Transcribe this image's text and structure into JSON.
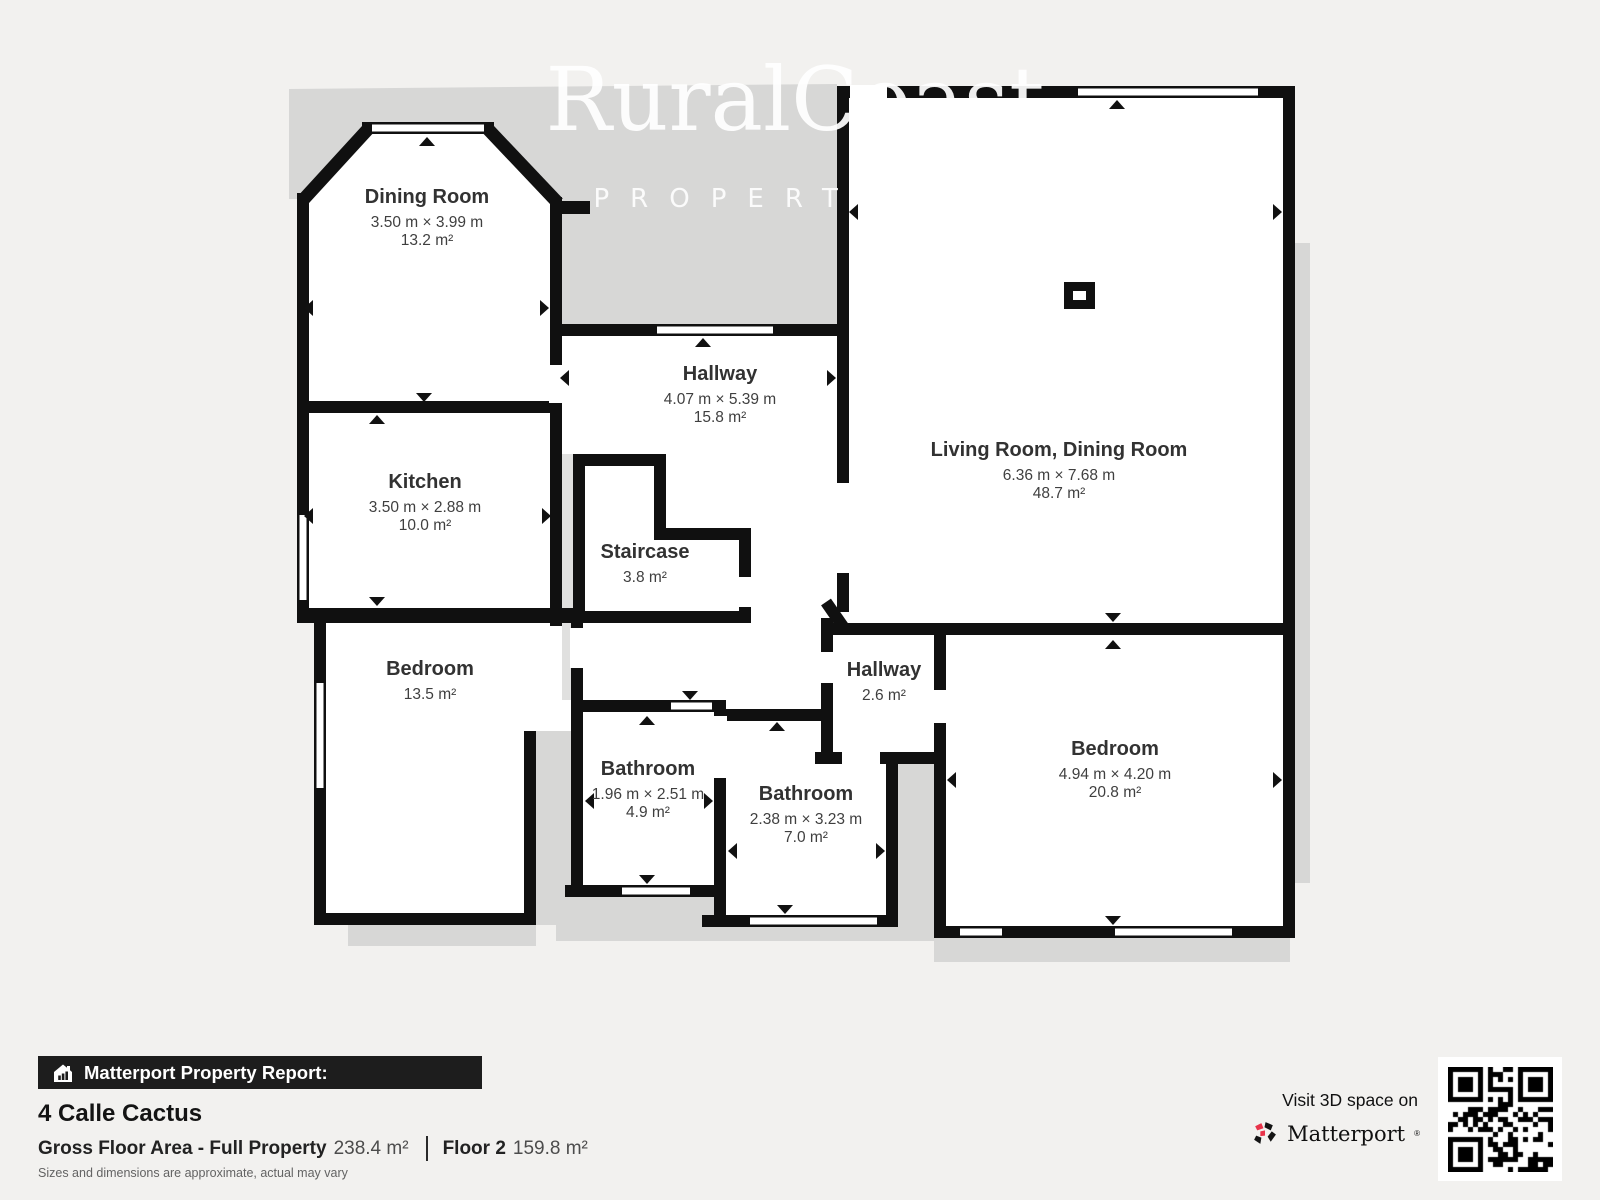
{
  "watermark": {
    "line1": "RuralCoast",
    "line2": "PROPERTIES"
  },
  "rooms": [
    {
      "name": "Dining Room",
      "dims": "3.50 m × 3.99 m",
      "area": "13.2 m²"
    },
    {
      "name": "Kitchen",
      "dims": "3.50 m × 2.88 m",
      "area": "10.0 m²"
    },
    {
      "name": "Bedroom",
      "dims": "",
      "area": "13.5 m²"
    },
    {
      "name": "Hallway",
      "dims": "4.07 m × 5.39 m",
      "area": "15.8 m²"
    },
    {
      "name": "Staircase",
      "dims": "",
      "area": "3.8 m²"
    },
    {
      "name": "Living Room, Dining Room",
      "dims": "6.36 m × 7.68 m",
      "area": "48.7 m²"
    },
    {
      "name": "Hallway",
      "dims": "",
      "area": "2.6 m²"
    },
    {
      "name": "Bathroom",
      "dims": "1.96 m × 2.51 m",
      "area": "4.9 m²"
    },
    {
      "name": "Bathroom",
      "dims": "2.38 m × 3.23 m",
      "area": "7.0 m²"
    },
    {
      "name": "Bedroom",
      "dims": "4.94 m × 4.20 m",
      "area": "20.8 m²"
    }
  ],
  "footer": {
    "report_label": "Matterport Property Report:",
    "address": "4 Calle Cactus",
    "gfa_label": "Gross Floor Area - Full Property",
    "gfa_value": "238.4 m²",
    "floor_label": "Floor 2",
    "floor_value": "159.8 m²",
    "disclaimer": "Sizes and dimensions are approximate, actual may vary",
    "cta": "Visit 3D space on",
    "brand": "Matterport",
    "brand_mark": "®"
  },
  "icons": {
    "report": "house-chart-icon",
    "brand": "matterport-pinwheel-icon",
    "qr": "qr-code"
  },
  "colors": {
    "wall": "#101010",
    "shadow": "#d7d7d6",
    "background": "#f2f1ef",
    "accent_red": "#e8334a"
  }
}
